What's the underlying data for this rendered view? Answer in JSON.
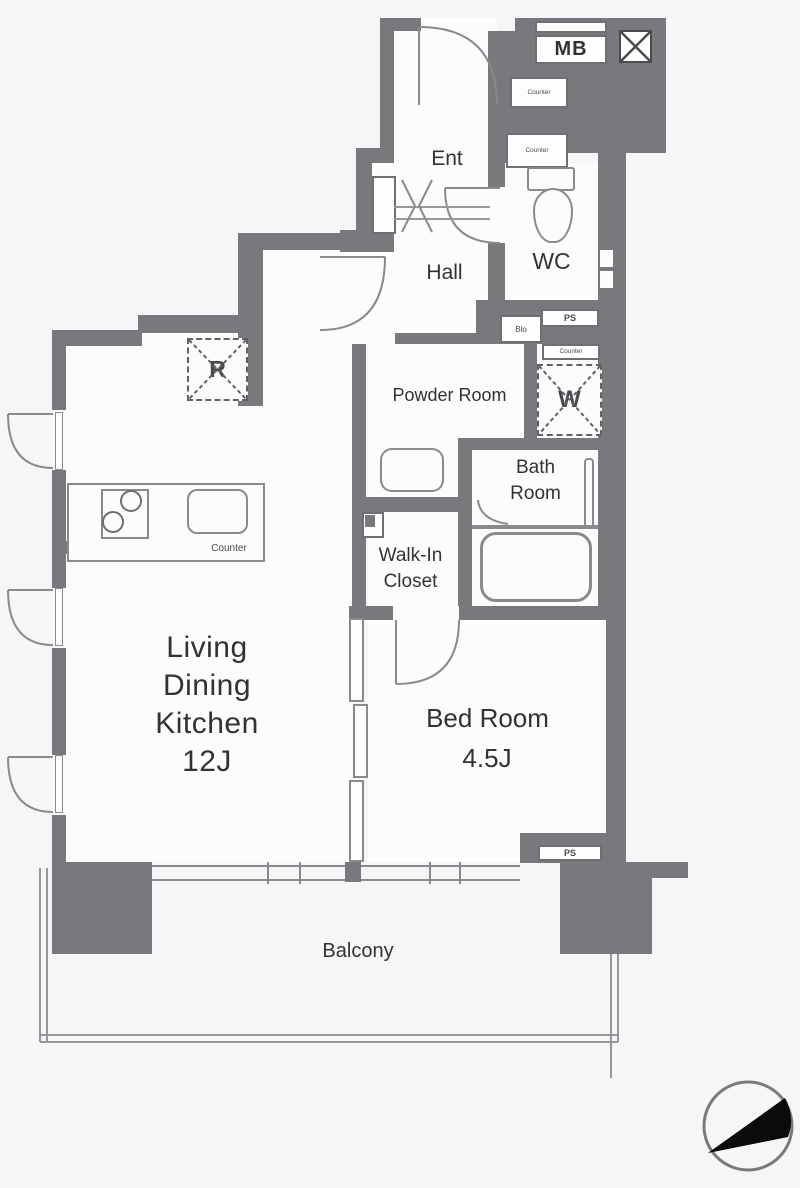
{
  "colors": {
    "background": "#f6f5f7",
    "wall": "#7a787c",
    "line": "#8b898d",
    "text": "#333134",
    "dashed_outline": "#626064",
    "compass_fill": "#0b0b0b"
  },
  "labels": {
    "ent": "Ent",
    "hall": "Hall",
    "wc": "WC",
    "powder_room": "Powder Room",
    "bath": [
      "Bath",
      "Room"
    ],
    "walk_in_closet": [
      "Walk-In",
      "Closet"
    ],
    "ldk": [
      "Living",
      "Dining",
      "Kitchen",
      "12J"
    ],
    "bed_room": [
      "Bed Room",
      "4.5J"
    ],
    "balcony": "Balcony",
    "meter_box": "MB",
    "pipe_space_top": "PS",
    "pipe_space_bottom": "PS",
    "refrigerator": "R",
    "washer": "W",
    "counter_kitchen": "Counter",
    "counter_entrance_upper": "Counter",
    "counter_entrance_lower": "Counter",
    "counter_laundry": "Counter",
    "vent": "Blo"
  }
}
